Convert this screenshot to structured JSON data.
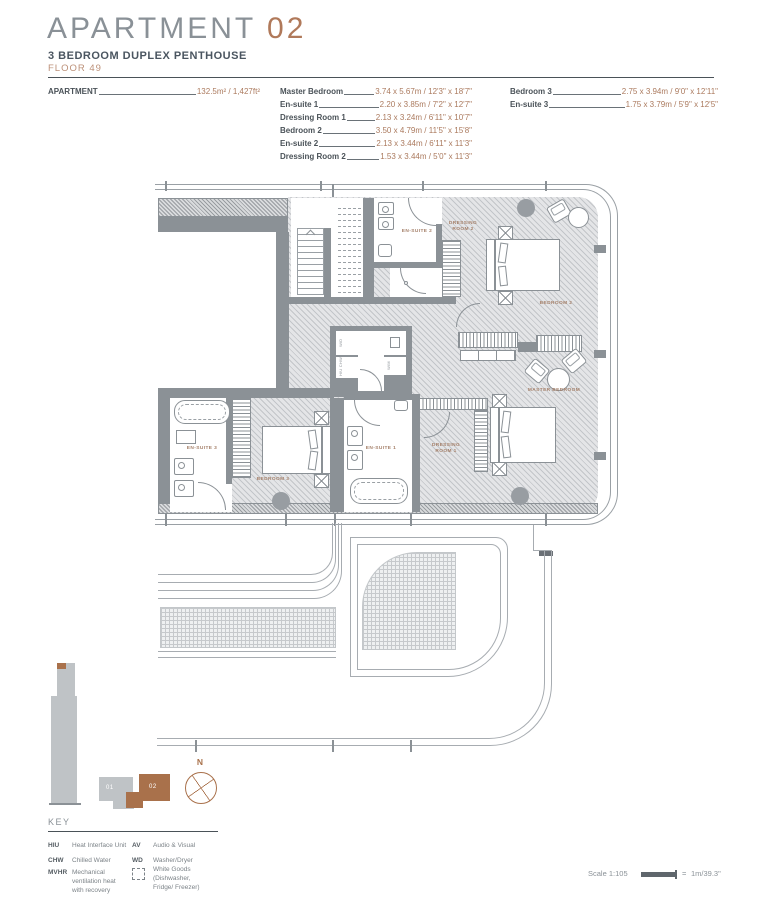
{
  "header": {
    "title_main": "APARTMENT",
    "title_number": "02",
    "subtitle": "3 BEDROOM DUPLEX PENTHOUSE",
    "floor": "FLOOR 49"
  },
  "dimensions": {
    "apartment": {
      "label": "APARTMENT",
      "value": "132.5m² / 1,427ft²"
    },
    "col2": [
      {
        "label": "Master Bedroom",
        "value": "3.74 x 5.67m / 12'3\" x 18'7\""
      },
      {
        "label": "En-suite 1",
        "value": "2.20 x 3.85m / 7'2\" x 12'7\""
      },
      {
        "label": "Dressing Room 1",
        "value": "2.13 x 3.24m / 6'11\" x 10'7\""
      },
      {
        "label": "Bedroom 2",
        "value": "3.50 x 4.79m / 11'5\" x 15'8\""
      },
      {
        "label": "En-suite 2",
        "value": "2.13 x 3.44m / 6'11\" x 11'3\""
      },
      {
        "label": "Dressing Room 2",
        "value": "1.53 x 3.44m / 5'0\" x 11'3\""
      }
    ],
    "col3": [
      {
        "label": "Bedroom 3",
        "value": "2.75 x 3.94m / 9'0\" x 12'11\""
      },
      {
        "label": "En-suite 3",
        "value": "1.75 x 3.79m / 5'9\" x 12'5\""
      }
    ]
  },
  "plan": {
    "rooms": [
      {
        "label": "EN-SUITE 2"
      },
      {
        "label": "DRESSING ROOM 2"
      },
      {
        "label": "BEDROOM 2"
      },
      {
        "label": "MASTER BEDROOM"
      },
      {
        "label": "DRESSING ROOM 1"
      },
      {
        "label": "EN-SUITE 1"
      },
      {
        "label": "BEDROOM 3"
      },
      {
        "label": "EN-SUITE 3"
      }
    ],
    "utility": [
      "W/D",
      "HIU CHW",
      "W/M"
    ]
  },
  "keyplan": {
    "unit1": "01",
    "unit2": "02",
    "north": "N"
  },
  "key": {
    "title": "KEY",
    "entries": [
      {
        "abbr": "HIU",
        "desc": "Heat Interface Unit"
      },
      {
        "abbr": "AV",
        "desc": "Audio & Visual"
      },
      {
        "abbr": "CHW",
        "desc": "Chilled Water"
      },
      {
        "abbr": "WD",
        "desc": "Washer/Dryer"
      },
      {
        "abbr": "MVHR",
        "desc": "Mechanical ventilation heat with recovery"
      },
      {
        "abbr": "",
        "desc": "White Goods (Dishwasher, Fridge/ Freezer)"
      }
    ]
  },
  "scale": {
    "label": "Scale 1:105",
    "equals": "=",
    "value": "1m/39.3\""
  },
  "colors": {
    "accent_copper": "#a9714b",
    "text_dark": "#4a5560",
    "wall_gray": "#8b9196"
  }
}
